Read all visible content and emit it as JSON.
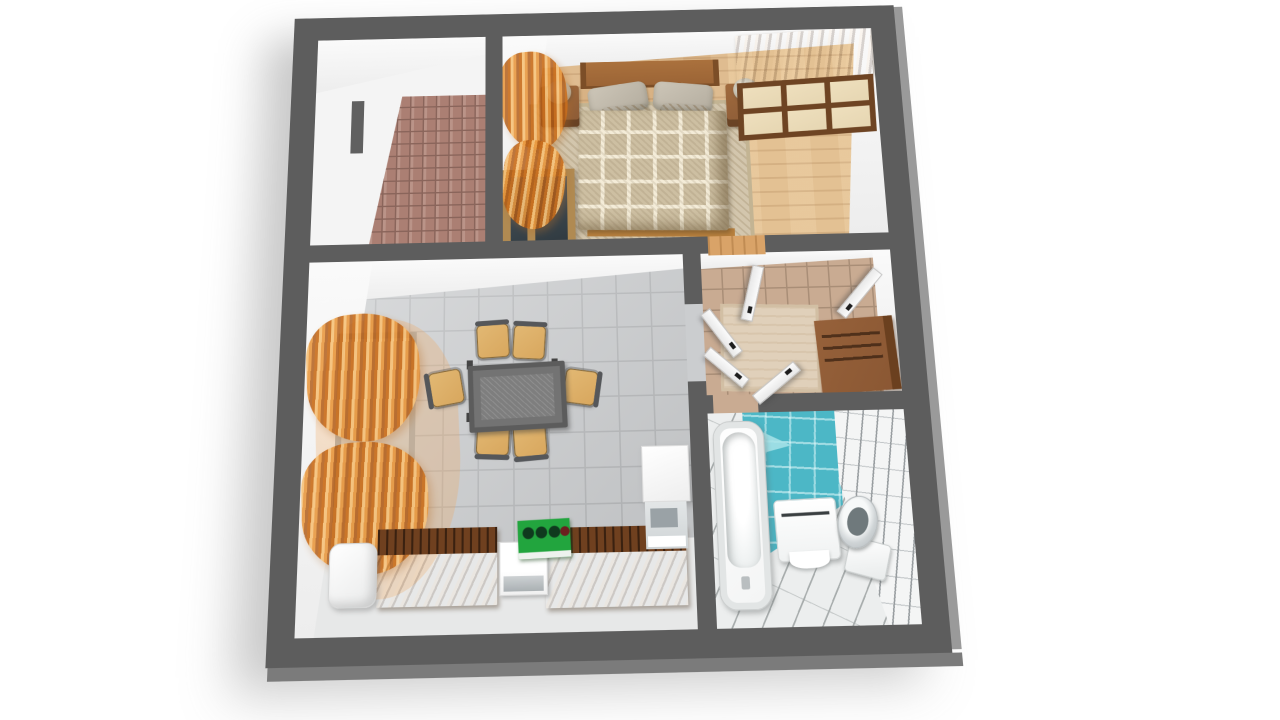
{
  "scene": {
    "type": "3d-floor-plan-render",
    "description": "3D top-down cutaway render of a one-bedroom apartment with dark gray walls on a white background",
    "background": "#ffffff",
    "text_visible": false
  },
  "palette": {
    "wall": "#5d5d5d",
    "wall-edge": "#9a9a9a",
    "wall-bottom-edge": "#7b7b7b",
    "inner-wall": "#f4f4f4",
    "bedroom-floor": "#d8b284",
    "bedroom-floor-light": "#e3c193",
    "bedroom-rug": "#d3c6ad",
    "blanket": "#cdbfa2",
    "headboard": "#9a6335",
    "nightstand": "#8a5a36",
    "pillow": "#b3ac9e",
    "wardrobe-frame": "#6e4423",
    "wardrobe-panel": "#e6d6b2",
    "curtain": "#e8953a",
    "balcony-tile": "#ab7f73",
    "balcony-grout": "#8a655b",
    "living-tile": "#cbcdcf",
    "living-grout": "#b6b8ba",
    "living-floor-light": "#e7e8e8",
    "hall-tile": "#c9ab92",
    "hall-grout": "#a98e77",
    "hall-rug": "#e0d0ba",
    "cabinet": "#8a5733",
    "bath-floor": "#eceeee",
    "bath-grout": "#a7acac",
    "bath-blue": "#4cb7c6",
    "bath-blue-light": "#a9e4e9",
    "bath-tile-white": "#f4f5f5",
    "tub": "#f3f4f4",
    "table": "#737373",
    "chair": "#d8a75e",
    "counter-top": "#6f401f",
    "stove": "#22a53e",
    "wood-door-floor": "#d9a368"
  },
  "rooms": {
    "balcony": {
      "name": "balcony",
      "features": [
        "red-tile-floor",
        "white-walls"
      ]
    },
    "bedroom": {
      "name": "bedroom",
      "features": [
        "double-bed",
        "checkered-blanket",
        "pillows",
        "headboard",
        "nightstand-left",
        "nightstand-right",
        "table-lamp-left",
        "table-lamp-right",
        "wardrobe-with-glass-doors",
        "area-rug",
        "parquet-floor",
        "orange-curtains",
        "wood-framed-window"
      ]
    },
    "living_room": {
      "name": "living-room-kitchen",
      "features": [
        "gray-tile-floor",
        "orange-curtains",
        "window",
        "dining-table",
        "six-chairs",
        "fridge",
        "kitchen-counter-left",
        "dishwasher-unit",
        "green-stove",
        "kitchen-counter-right",
        "wall-cabinet",
        "vanity-sink"
      ]
    },
    "hallway": {
      "name": "hallway",
      "features": [
        "beige-tile-floor",
        "runner-rug",
        "open-door-bedroom",
        "open-door-right",
        "open-doors-living",
        "open-door-bathroom",
        "shelf-cabinet"
      ]
    },
    "bathroom": {
      "name": "bathroom",
      "features": [
        "bathtub",
        "washbasin",
        "toilet",
        "blue-tile-wall",
        "white-tile-wall",
        "diagonal-tile-floor"
      ]
    }
  }
}
